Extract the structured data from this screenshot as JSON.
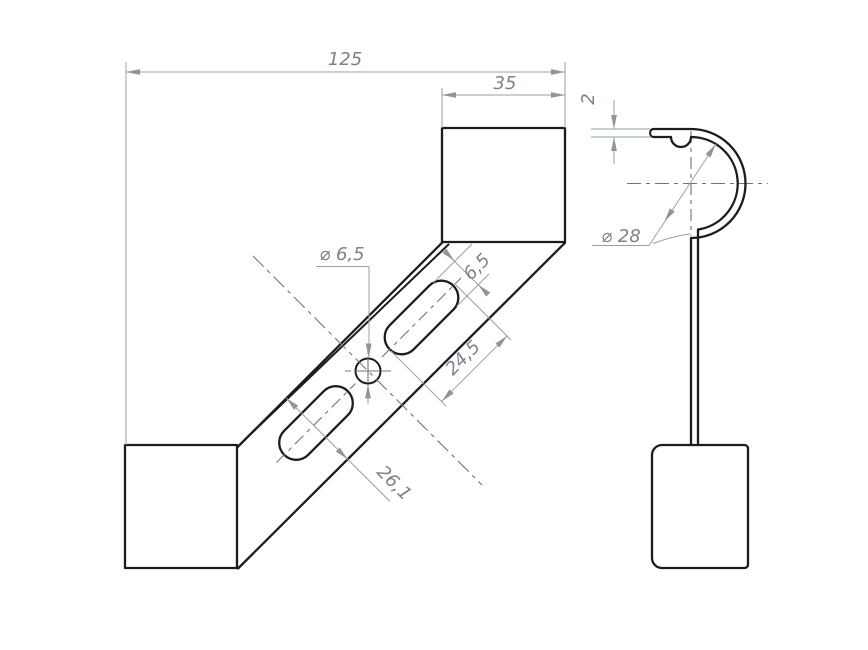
{
  "colors": {
    "background": "#ffffff",
    "object_line": "#1c1c1c",
    "thin_line": "#9aa0a6",
    "center_line": "#6f747b",
    "dimension_text": "#7b828b"
  },
  "front_view": {
    "dimensions": {
      "overall_width": "125",
      "top_plate_width": "35",
      "hole_diameter": "⌀ 6,5",
      "slot_width": "6,5",
      "slot_length": "24,5",
      "strap_width": "26,1"
    }
  },
  "side_view": {
    "dimensions": {
      "sheet_thickness": "2",
      "clamp_diameter": "⌀ 28"
    }
  }
}
